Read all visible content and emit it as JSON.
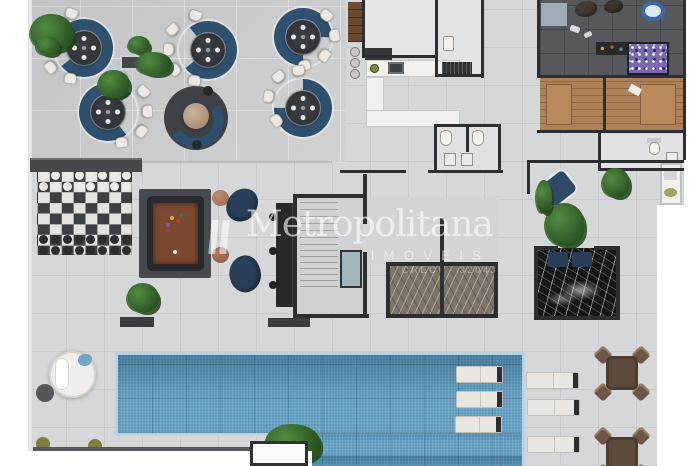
{
  "watermark": {
    "brand": "Metropolitana",
    "subtitle": "IMÓVEIS",
    "license": "CRECI - 3204J",
    "color": "#ffffff"
  },
  "palette": {
    "page_bg": "#ffffff",
    "lounge_floor": "#c6c8c9",
    "deck_floor": "#d5d7d9",
    "wall": "#2c2e31",
    "sofa_navy": "#30506f",
    "table_dark": "#34373b",
    "chair_white": "#ece9e5",
    "pool_water": "#5d9abc",
    "pool_coping": "#b9d3e0",
    "chess_dark": "#3d4043",
    "chess_light": "#e3e3e1",
    "billiard_felt": "#7b4830",
    "sauna_wood": "#ad8159",
    "spa_marble": "#141517",
    "ball_pit": "#7868b0",
    "plant_green": "#2e5a26",
    "patio_wood": "#5c4a3d"
  }
}
